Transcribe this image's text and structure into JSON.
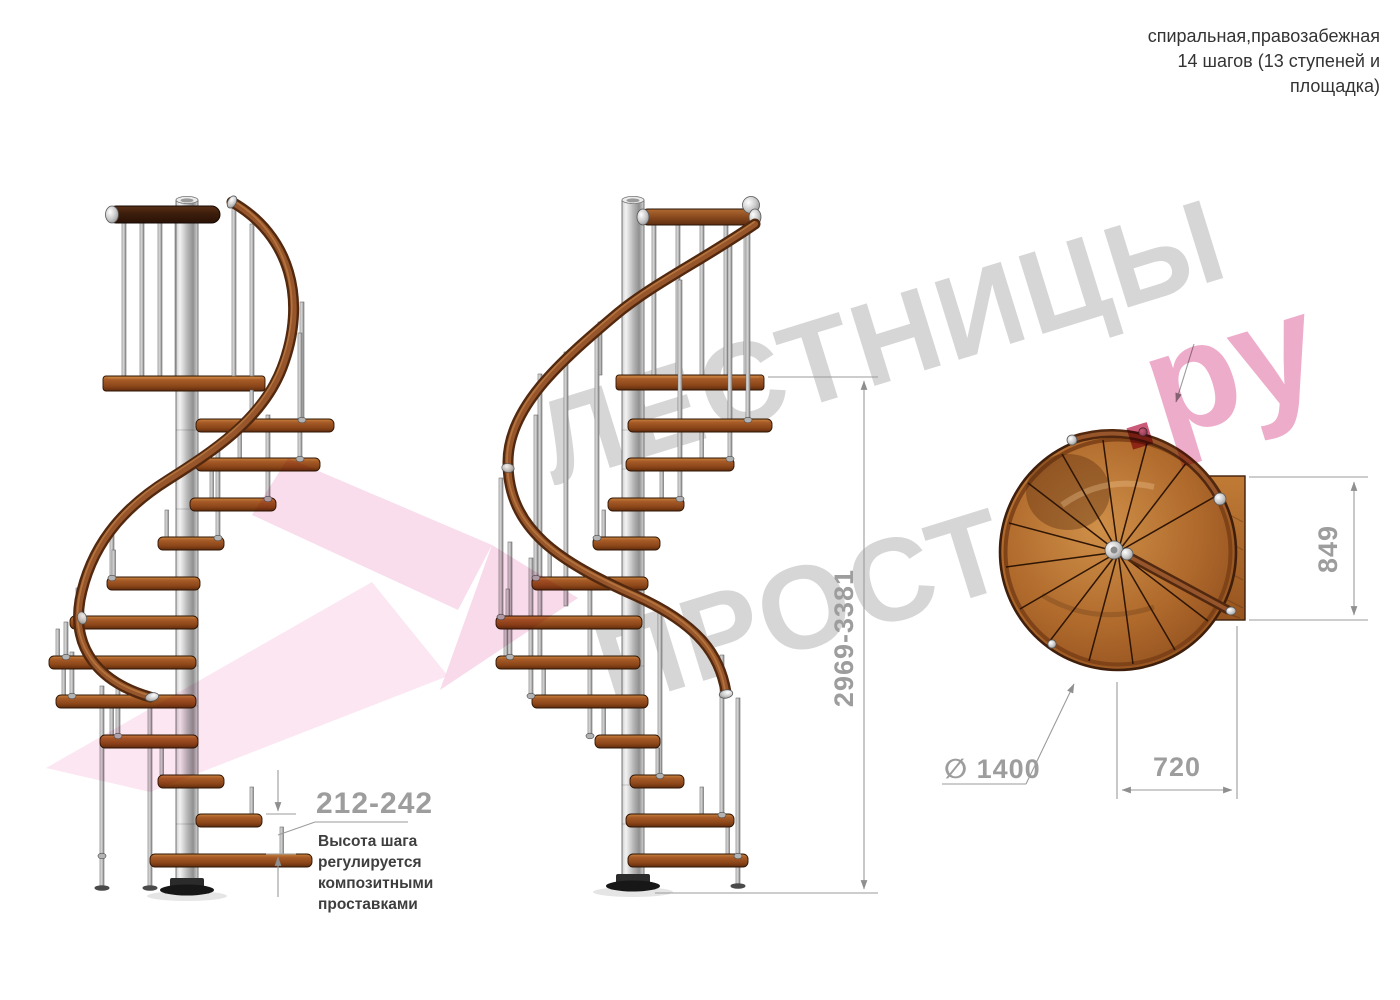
{
  "header": {
    "line1": "спиральная,правозабежная",
    "line2": "14 шагов (13 ступеней и",
    "line3": "площадка)"
  },
  "watermark": {
    "brand_top": "ЛЕСТНИЦЫ",
    "brand_bottom": "ПРОСТО",
    "suffix_dot": ".",
    "suffix_text": "ру"
  },
  "dimensions": {
    "step_height": "212-242",
    "total_height": "2969-3381",
    "landing_width": "849",
    "landing_depth": "720",
    "diameter": "∅ 1400"
  },
  "annotation": {
    "lines": [
      "Высота шага",
      "регулируется",
      "композитными",
      "проставками"
    ]
  },
  "colors": {
    "wood": "#a85c28",
    "wood_dark": "#5f2c0e",
    "wood_plan": "#b06a2c",
    "rail_dark": "#3c1d0c",
    "metal": "#c9c9c9",
    "dimension_gray": "#9b9b9b",
    "annotation_text": "#3e3e3e",
    "watermark_gray": "#d6d6d6",
    "watermark_pink": "#eeaccb",
    "arrow_pink": "#f6c8e0"
  }
}
